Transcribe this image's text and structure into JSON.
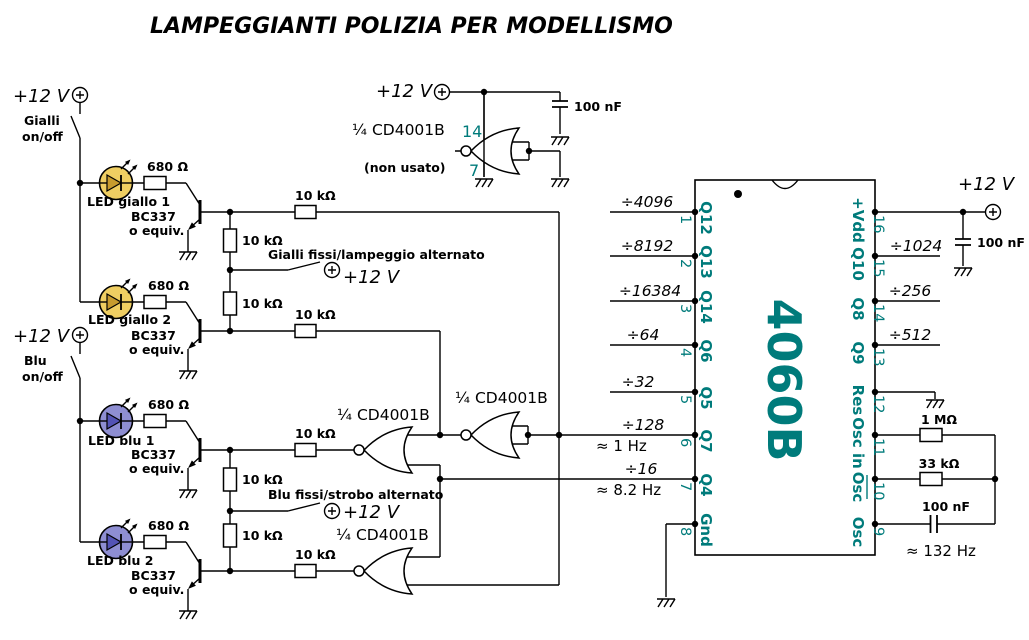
{
  "title": "LAMPEGGIANTI POLIZIA PER MODELLISMO",
  "colors": {
    "teal": "#007B7B",
    "led_yellow": "#EFCE62",
    "led_yellow_dark": "#C79B2E",
    "led_blue": "#8E8ED2",
    "led_blue_dark": "#5353B5"
  },
  "supply": {
    "label": "+12 V"
  },
  "sections": {
    "gialli": {
      "switch_line1": "Gialli",
      "switch_line2": "on/off",
      "mode_switch": "Gialli fissi/lampeggio alternato",
      "led1": "LED giallo 1",
      "led2": "LED giallo 2"
    },
    "blu": {
      "switch_line1": "Blu",
      "switch_line2": "on/off",
      "mode_switch": "Blu fissi/strobo alternato",
      "led1": "LED blu 1",
      "led2": "LED blu 2"
    }
  },
  "transistor": {
    "part": "BC337",
    "equiv": "o equiv."
  },
  "resistors": {
    "r680": "680 Ω",
    "r10k": "10 kΩ",
    "r1m": "1 MΩ",
    "r33k": "33 kΩ"
  },
  "capacitors": {
    "c100n": "100 nF"
  },
  "gates": {
    "quarter": "¼ CD4001B",
    "unused": "(non usato)",
    "pin_vdd": "14",
    "pin_vss": "7"
  },
  "ic": {
    "name": "4060B",
    "left_pins": [
      {
        "n": "1",
        "label": "Q12",
        "div": "÷4096"
      },
      {
        "n": "2",
        "label": "Q13",
        "div": "÷8192"
      },
      {
        "n": "3",
        "label": "Q14",
        "div": "÷16384"
      },
      {
        "n": "4",
        "label": "Q6",
        "div": "÷64"
      },
      {
        "n": "5",
        "label": "Q5",
        "div": "÷32"
      },
      {
        "n": "6",
        "label": "Q7",
        "div": "÷128",
        "freq": "≈ 1 Hz"
      },
      {
        "n": "7",
        "label": "Q4",
        "div": "÷16",
        "freq": "≈ 8.2 Hz"
      },
      {
        "n": "8",
        "label": "Gnd"
      }
    ],
    "right_pins": [
      {
        "n": "16",
        "label": "+Vdd"
      },
      {
        "n": "15",
        "label": "Q10",
        "div": "÷1024"
      },
      {
        "n": "14",
        "label": "Q8",
        "div": "÷256"
      },
      {
        "n": "13",
        "label": "Q9",
        "div": "÷512"
      },
      {
        "n": "12",
        "label": "Res"
      },
      {
        "n": "11",
        "label": "Osc in"
      },
      {
        "n": "10",
        "label": "Osc"
      },
      {
        "n": "9",
        "label": "Osc"
      }
    ]
  },
  "oscillator": {
    "freq": "≈ 132 Hz"
  }
}
